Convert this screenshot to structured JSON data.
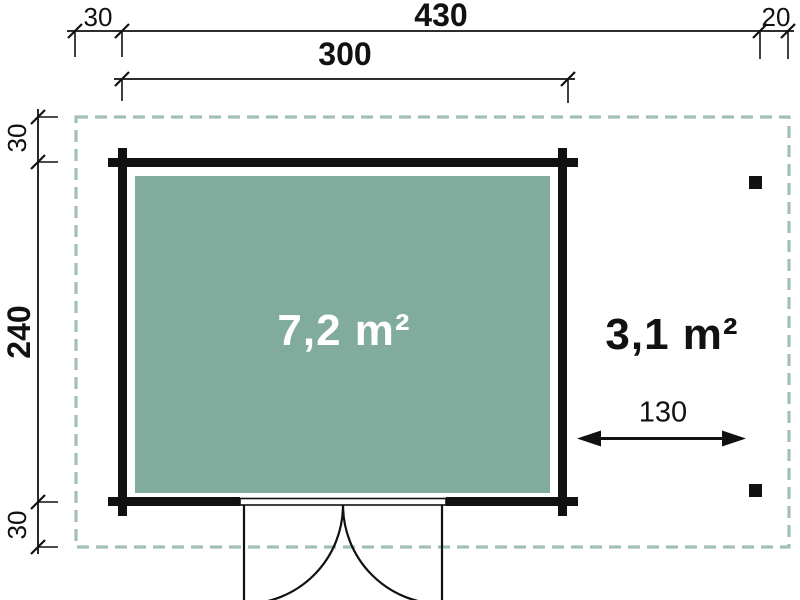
{
  "colors": {
    "wall": "#111111",
    "line": "#111111",
    "interior_fill": "#81ab9d",
    "dashed_border": "#a2c1b5",
    "area_text_light": "#ffffff",
    "background": "#ffffff"
  },
  "dimensions": {
    "top": {
      "left_offset": "30",
      "overall_width": "430",
      "right_offset": "20",
      "cabin_width": "300"
    },
    "left": {
      "top_offset": "30",
      "cabin_depth": "240",
      "bottom_offset": "30"
    },
    "side_area_width": "130"
  },
  "areas": {
    "interior": "7,2 m²",
    "side": "3,1 m²"
  }
}
